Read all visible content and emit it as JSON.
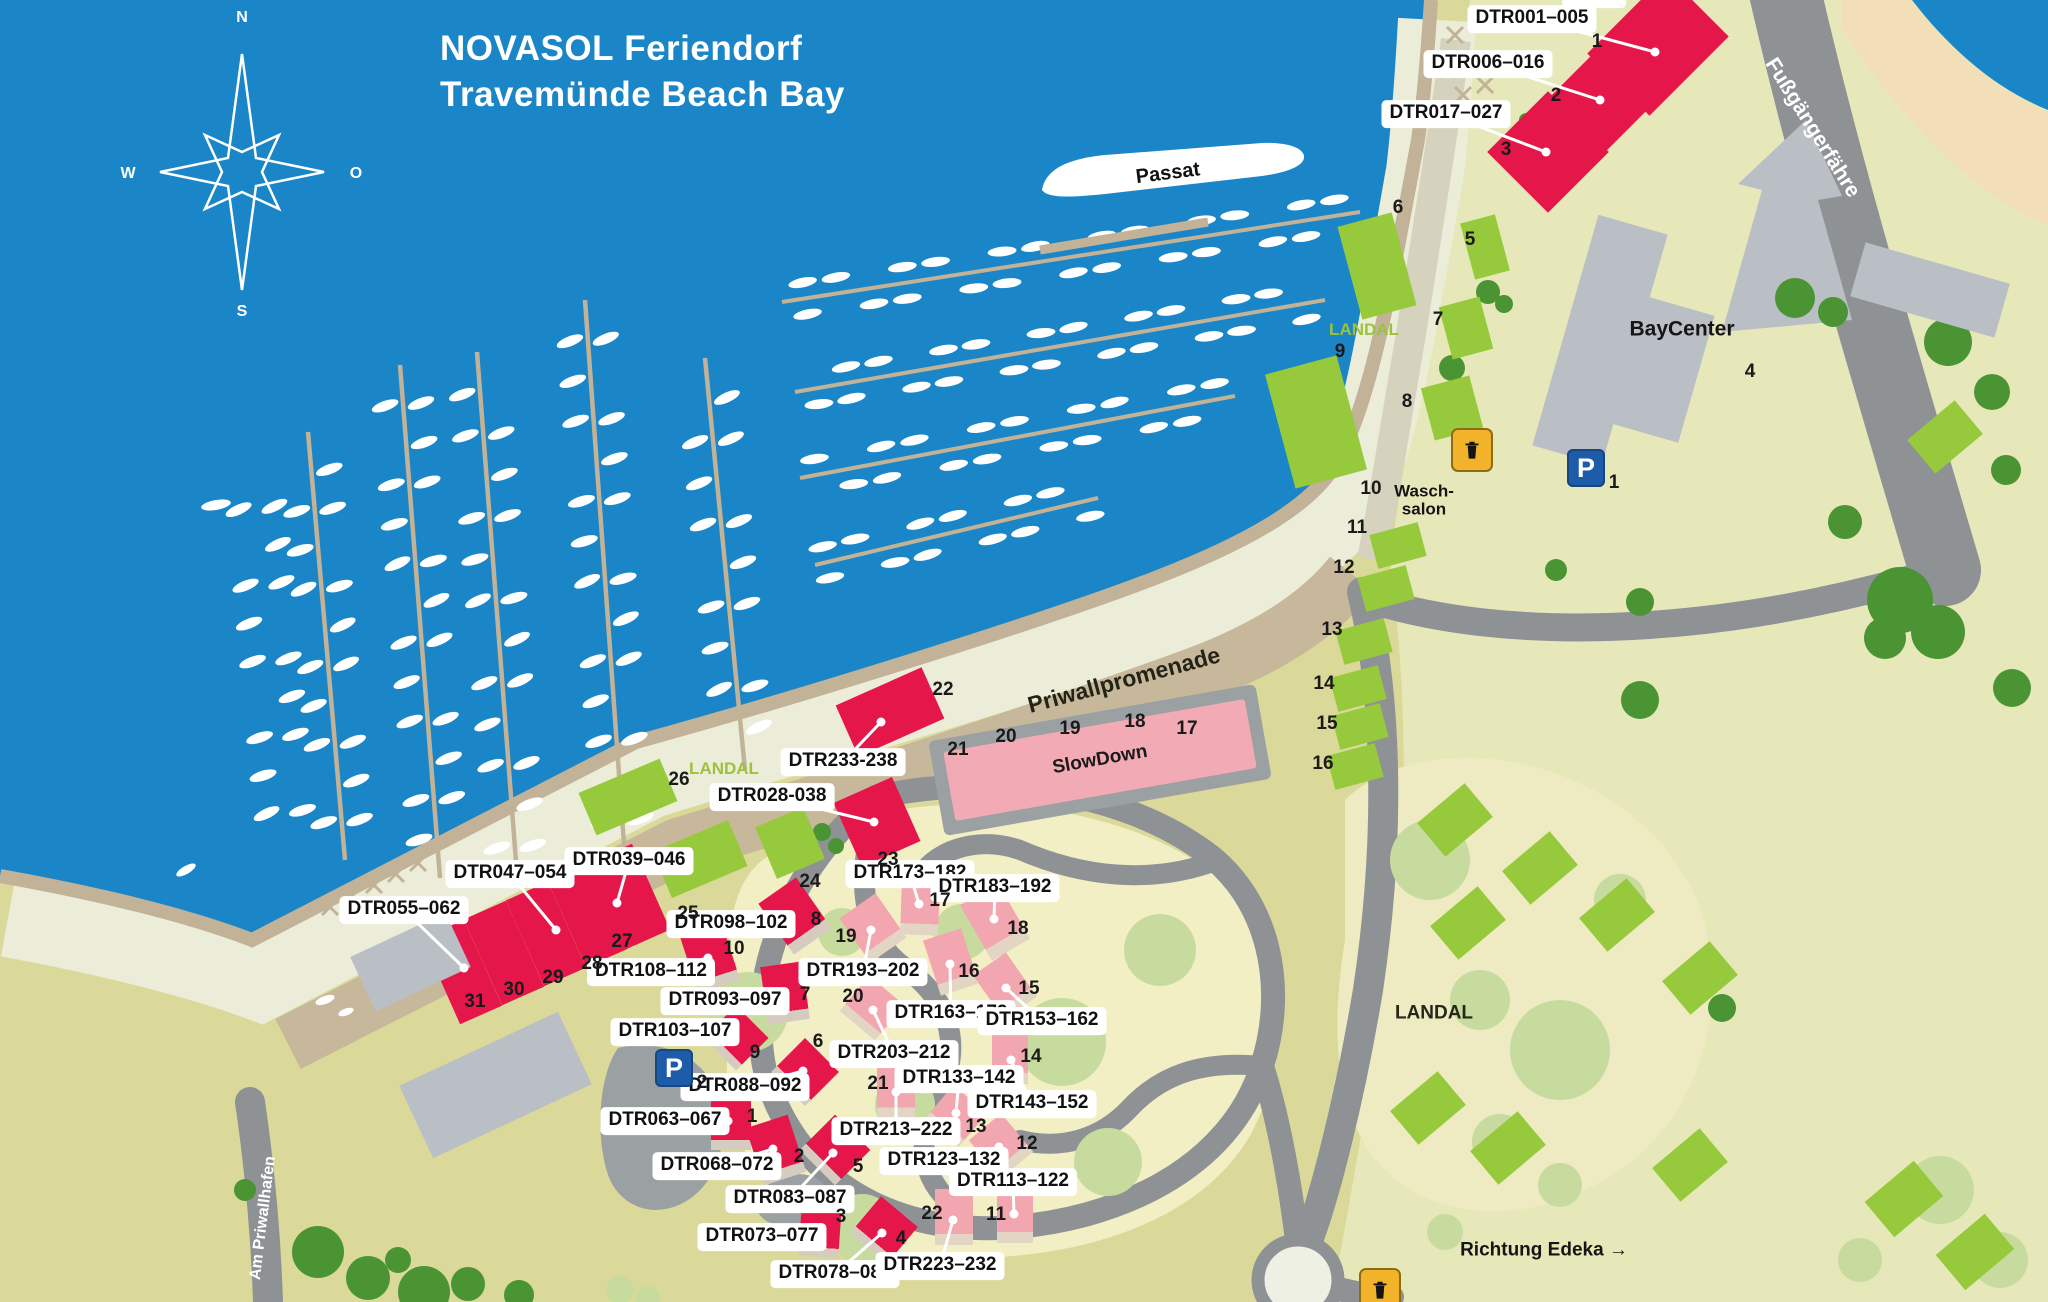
{
  "title": {
    "brand": "NOVASOL",
    "line1_rest": " Feriendorf",
    "line2": "Travemünde Beach Bay"
  },
  "compass": {
    "n": "N",
    "e": "O",
    "s": "S",
    "w": "W"
  },
  "colors": {
    "water": "#1a86c7",
    "land": "#dbd999",
    "land_pale": "#e7e8ba",
    "sand": "#f3dfb7",
    "road": "#8e9295",
    "promenade": "#c8b89b",
    "shore": "#c2b298",
    "cream": "#ecedd9",
    "red": "#e5174a",
    "pink": "#f2a6b0",
    "green": "#97c93c",
    "gray_building": "#b9bfc4",
    "landal_text": "#9cc23d",
    "parking_blue": "#1e5ba8",
    "trash_yellow": "#f2b32b"
  },
  "map_texts": [
    {
      "name": "passat-label",
      "text": "Passat",
      "x": 1168,
      "y": 174,
      "rot": -7,
      "size": 20,
      "color": "#101010",
      "weight": 700
    },
    {
      "name": "priwallpromenade-label",
      "text": "Priwallpromenade",
      "x": 1124,
      "y": 680,
      "rot": -15,
      "size": 23,
      "color": "#232317",
      "weight": 700
    },
    {
      "name": "fussgaengerfaehre-label",
      "text": "Fußgängerfähre",
      "x": 1812,
      "y": 128,
      "rot": 58,
      "size": 21,
      "color": "#ffffff",
      "weight": 700
    },
    {
      "name": "am-priwallhafen-label",
      "text": "Am Priwallhafen",
      "x": 263,
      "y": 1218,
      "rot": -83,
      "size": 16,
      "color": "#ffffff",
      "weight": 700
    },
    {
      "name": "baycenter-label",
      "text": "BayCenter",
      "x": 1682,
      "y": 330,
      "rot": 0,
      "size": 21,
      "color": "#151515",
      "weight": 700
    },
    {
      "name": "waschsalon-label",
      "text": "Wasch-\nsalon",
      "x": 1424,
      "y": 501,
      "rot": 0,
      "size": 17,
      "color": "#151515",
      "weight": 700
    },
    {
      "name": "landal-top-label",
      "text": "LANDAL",
      "x": 1364,
      "y": 330,
      "rot": 0,
      "size": 17,
      "color": "#9cc23d",
      "weight": 700
    },
    {
      "name": "landal-promenade-label",
      "text": "LANDAL",
      "x": 724,
      "y": 769,
      "rot": 0,
      "size": 17,
      "color": "#9cc23d",
      "weight": 700
    },
    {
      "name": "landal-right-label",
      "text": "LANDAL",
      "x": 1434,
      "y": 1014,
      "rot": 0,
      "size": 19,
      "color": "#262619",
      "weight": 700
    },
    {
      "name": "richtung-edeka-label",
      "text": "Richtung Edeka →",
      "x": 1544,
      "y": 1251,
      "rot": 0,
      "size": 19,
      "color": "#151515",
      "weight": 700
    }
  ],
  "slowdown": {
    "label": "SlowDown",
    "x": 1100,
    "y": 760,
    "w": 306,
    "h": 70,
    "pad_w": 332,
    "pad_h": 96,
    "rot": -10
  },
  "unit_labels": [
    {
      "t": "DTR001–005",
      "x": 1532,
      "y": 19,
      "tx": 1655,
      "ty": 52
    },
    {
      "t": "DTR006–016",
      "x": 1488,
      "y": 64,
      "tx": 1600,
      "ty": 100
    },
    {
      "t": "DTR017–027",
      "x": 1446,
      "y": 114,
      "tx": 1546,
      "ty": 152
    },
    {
      "t": "DTR233-238",
      "x": 843,
      "y": 762,
      "tx": 881,
      "ty": 722
    },
    {
      "t": "DTR028-038",
      "x": 772,
      "y": 797,
      "tx": 874,
      "ty": 822
    },
    {
      "t": "DTR039–046",
      "x": 629,
      "y": 861,
      "tx": 617,
      "ty": 903
    },
    {
      "t": "DTR047–054",
      "x": 510,
      "y": 874,
      "tx": 556,
      "ty": 930
    },
    {
      "t": "DTR055–062",
      "x": 404,
      "y": 910,
      "tx": 464,
      "ty": 968
    },
    {
      "t": "DTR098–102",
      "x": 731,
      "y": 924,
      "tx": 790,
      "ty": 918
    },
    {
      "t": "DTR108–112",
      "x": 651,
      "y": 972,
      "tx": 708,
      "ty": 958
    },
    {
      "t": "DTR093–097",
      "x": 725,
      "y": 1001,
      "tx": 782,
      "ty": 995
    },
    {
      "t": "DTR103–107",
      "x": 675,
      "y": 1032,
      "tx": 734,
      "ty": 1038
    },
    {
      "t": "DTR088–092",
      "x": 745,
      "y": 1087,
      "tx": 803,
      "ty": 1071
    },
    {
      "t": "DTR063–067",
      "x": 665,
      "y": 1121,
      "tx": 728,
      "ty": 1121
    },
    {
      "t": "DTR068–072",
      "x": 717,
      "y": 1166,
      "tx": 773,
      "ty": 1149
    },
    {
      "t": "DTR083–087",
      "x": 790,
      "y": 1199,
      "tx": 833,
      "ty": 1153
    },
    {
      "t": "DTR073–077",
      "x": 762,
      "y": 1237,
      "tx": 817,
      "ty": 1230
    },
    {
      "t": "DTR078–082",
      "x": 835,
      "y": 1274,
      "tx": 882,
      "ty": 1233
    },
    {
      "t": "DTR173–182",
      "x": 910,
      "y": 874,
      "tx": 919,
      "ty": 904
    },
    {
      "t": "DTR183–192",
      "x": 995,
      "y": 888,
      "tx": 994,
      "ty": 919
    },
    {
      "t": "DTR193–202",
      "x": 863,
      "y": 972,
      "tx": 871,
      "ty": 930
    },
    {
      "t": "DTR163–172",
      "x": 951,
      "y": 1014,
      "tx": 950,
      "ty": 964
    },
    {
      "t": "DTR153–162",
      "x": 1042,
      "y": 1021,
      "tx": 1006,
      "ty": 988
    },
    {
      "t": "DTR203–212",
      "x": 894,
      "y": 1054,
      "tx": 873,
      "ty": 1010
    },
    {
      "t": "DTR133–142",
      "x": 959,
      "y": 1079,
      "tx": 956,
      "ty": 1113
    },
    {
      "t": "DTR143–152",
      "x": 1032,
      "y": 1104,
      "tx": 1011,
      "ty": 1060
    },
    {
      "t": "DTR213–222",
      "x": 896,
      "y": 1131,
      "tx": 896,
      "ty": 1092
    },
    {
      "t": "DTR123–132",
      "x": 944,
      "y": 1161,
      "tx": 999,
      "ty": 1147
    },
    {
      "t": "DTR113–122",
      "x": 1013,
      "y": 1182,
      "tx": 1014,
      "ty": 1214
    },
    {
      "t": "DTR223–232",
      "x": 940,
      "y": 1266,
      "tx": 953,
      "ty": 1220
    },
    {
      "t": "Bahn",
      "x": 1594,
      "y": -6,
      "tx": null,
      "ty": null
    }
  ],
  "numbers": [
    [
      "1",
      1597,
      42
    ],
    [
      "2",
      1556,
      96
    ],
    [
      "3",
      1506,
      150
    ],
    [
      "6",
      1398,
      208
    ],
    [
      "5",
      1470,
      240
    ],
    [
      "7",
      1438,
      320
    ],
    [
      "8",
      1407,
      402
    ],
    [
      "9",
      1340,
      352
    ],
    [
      "10",
      1371,
      489
    ],
    [
      "11",
      1357,
      528
    ],
    [
      "12",
      1344,
      568
    ],
    [
      "13",
      1332,
      630
    ],
    [
      "14",
      1324,
      684
    ],
    [
      "15",
      1327,
      724
    ],
    [
      "16",
      1323,
      764
    ],
    [
      "4",
      1750,
      372
    ],
    [
      "22",
      943,
      690
    ],
    [
      "21",
      958,
      750
    ],
    [
      "20",
      1006,
      737
    ],
    [
      "19",
      1070,
      729
    ],
    [
      "18",
      1135,
      722
    ],
    [
      "17",
      1187,
      729
    ],
    [
      "23",
      888,
      860
    ],
    [
      "24",
      810,
      882
    ],
    [
      "25",
      688,
      914
    ],
    [
      "26",
      679,
      780
    ],
    [
      "27",
      622,
      942
    ],
    [
      "28",
      592,
      964
    ],
    [
      "29",
      553,
      978
    ],
    [
      "30",
      514,
      990
    ],
    [
      "31",
      475,
      1002
    ],
    [
      "8",
      816,
      920
    ],
    [
      "10",
      734,
      949
    ],
    [
      "7",
      805,
      995
    ],
    [
      "9",
      755,
      1053
    ],
    [
      "6",
      818,
      1042
    ],
    [
      "1",
      752,
      1117
    ],
    [
      "2",
      799,
      1157
    ],
    [
      "5",
      858,
      1167
    ],
    [
      "3",
      841,
      1217
    ],
    [
      "4",
      901,
      1239
    ],
    [
      "17",
      940,
      901
    ],
    [
      "18",
      1018,
      929
    ],
    [
      "19",
      846,
      937
    ],
    [
      "16",
      969,
      972
    ],
    [
      "15",
      1029,
      989
    ],
    [
      "20",
      853,
      997
    ],
    [
      "14",
      1031,
      1057
    ],
    [
      "21",
      878,
      1084
    ],
    [
      "13",
      976,
      1127
    ],
    [
      "12",
      1027,
      1144
    ],
    [
      "22",
      932,
      1214
    ],
    [
      "11",
      996,
      1215
    ]
  ],
  "buildings": {
    "red": [
      [
        1658,
        45,
        112,
        88,
        -45
      ],
      [
        1602,
        100,
        80,
        78,
        -45
      ],
      [
        1548,
        152,
        86,
        86,
        -45
      ],
      [
        890,
        712,
        94,
        56,
        -24
      ],
      [
        877,
        822,
        64,
        70,
        -24
      ],
      [
        616,
        905,
        54,
        80,
        -24
      ],
      [
        462,
        972,
        46,
        94,
        -24
      ],
      [
        504,
        953,
        46,
        94,
        -24
      ],
      [
        546,
        934,
        46,
        94,
        -24
      ],
      [
        588,
        915,
        46,
        94,
        -24
      ],
      [
        630,
        896,
        46,
        94,
        -24
      ],
      [
        795,
        916,
        46,
        62,
        -35,
        1
      ],
      [
        710,
        958,
        44,
        60,
        -18,
        1
      ],
      [
        785,
        993,
        42,
        58,
        -8,
        1
      ],
      [
        736,
        1038,
        46,
        46,
        45,
        1
      ],
      [
        805,
        1072,
        48,
        48,
        45,
        1
      ],
      [
        731,
        1122,
        40,
        56,
        0,
        1
      ],
      [
        776,
        1150,
        44,
        60,
        -18,
        1
      ],
      [
        835,
        1150,
        50,
        50,
        45,
        1
      ],
      [
        820,
        1231,
        40,
        52,
        4,
        1
      ],
      [
        884,
        1230,
        48,
        48,
        40,
        1
      ]
    ],
    "pink": [
      [
        920,
        907,
        38,
        56,
        2,
        1
      ],
      [
        873,
        928,
        44,
        54,
        -35,
        1
      ],
      [
        995,
        922,
        44,
        64,
        -30,
        1
      ],
      [
        951,
        962,
        40,
        58,
        -18,
        1
      ],
      [
        1005,
        986,
        40,
        54,
        -35,
        1
      ],
      [
        872,
        1008,
        46,
        46,
        40,
        1
      ],
      [
        1010,
        1057,
        36,
        54,
        0,
        1
      ],
      [
        896,
        1090,
        38,
        58,
        0,
        1
      ],
      [
        956,
        1116,
        44,
        44,
        40,
        1
      ],
      [
        1001,
        1146,
        42,
        50,
        -40,
        1
      ],
      [
        954,
        1217,
        38,
        56,
        0,
        1
      ],
      [
        1015,
        1216,
        36,
        54,
        0,
        1
      ]
    ],
    "green": [
      [
        1377,
        266,
        56,
        96,
        -15
      ],
      [
        1485,
        247,
        36,
        58,
        -15
      ],
      [
        1466,
        328,
        42,
        54,
        -15
      ],
      [
        1452,
        408,
        50,
        54,
        -15
      ],
      [
        1316,
        422,
        74,
        118,
        -15
      ],
      [
        1398,
        545,
        50,
        35,
        -15
      ],
      [
        1386,
        588,
        50,
        35,
        -15
      ],
      [
        1364,
        641,
        50,
        35,
        -15
      ],
      [
        1358,
        688,
        50,
        35,
        -15
      ],
      [
        1360,
        726,
        50,
        35,
        -15
      ],
      [
        1355,
        766,
        50,
        35,
        -15
      ],
      [
        628,
        797,
        88,
        46,
        -23
      ],
      [
        700,
        859,
        82,
        50,
        -23
      ],
      [
        790,
        843,
        52,
        56,
        -23
      ],
      [
        1455,
        820,
        62,
        44,
        -40
      ],
      [
        1540,
        868,
        62,
        44,
        -40
      ],
      [
        1617,
        915,
        62,
        44,
        -40
      ],
      [
        1468,
        923,
        62,
        44,
        -40
      ],
      [
        1700,
        978,
        62,
        44,
        -40
      ],
      [
        1428,
        1108,
        62,
        44,
        -40
      ],
      [
        1508,
        1148,
        62,
        44,
        -40
      ],
      [
        1690,
        1165,
        62,
        44,
        -40
      ],
      [
        1945,
        437,
        62,
        44,
        -40
      ],
      [
        1904,
        1199,
        64,
        46,
        -40
      ],
      [
        1975,
        1252,
        64,
        46,
        -40
      ]
    ],
    "gray": [
      [
        1600,
        340,
        72,
        240,
        16
      ],
      [
        1657,
        368,
        82,
        132,
        16
      ],
      [
        1930,
        290,
        150,
        56,
        16
      ],
      [
        410,
        962,
        105,
        60,
        -25
      ],
      [
        495,
        1085,
        175,
        80,
        -25
      ]
    ]
  },
  "icons": {
    "parking": [
      {
        "x": 1586,
        "y": 468,
        "label": "1"
      },
      {
        "x": 674,
        "y": 1068,
        "label": "2"
      }
    ],
    "trash": [
      {
        "x": 1470,
        "y": 448
      },
      {
        "x": 1378,
        "y": 1288
      }
    ]
  }
}
